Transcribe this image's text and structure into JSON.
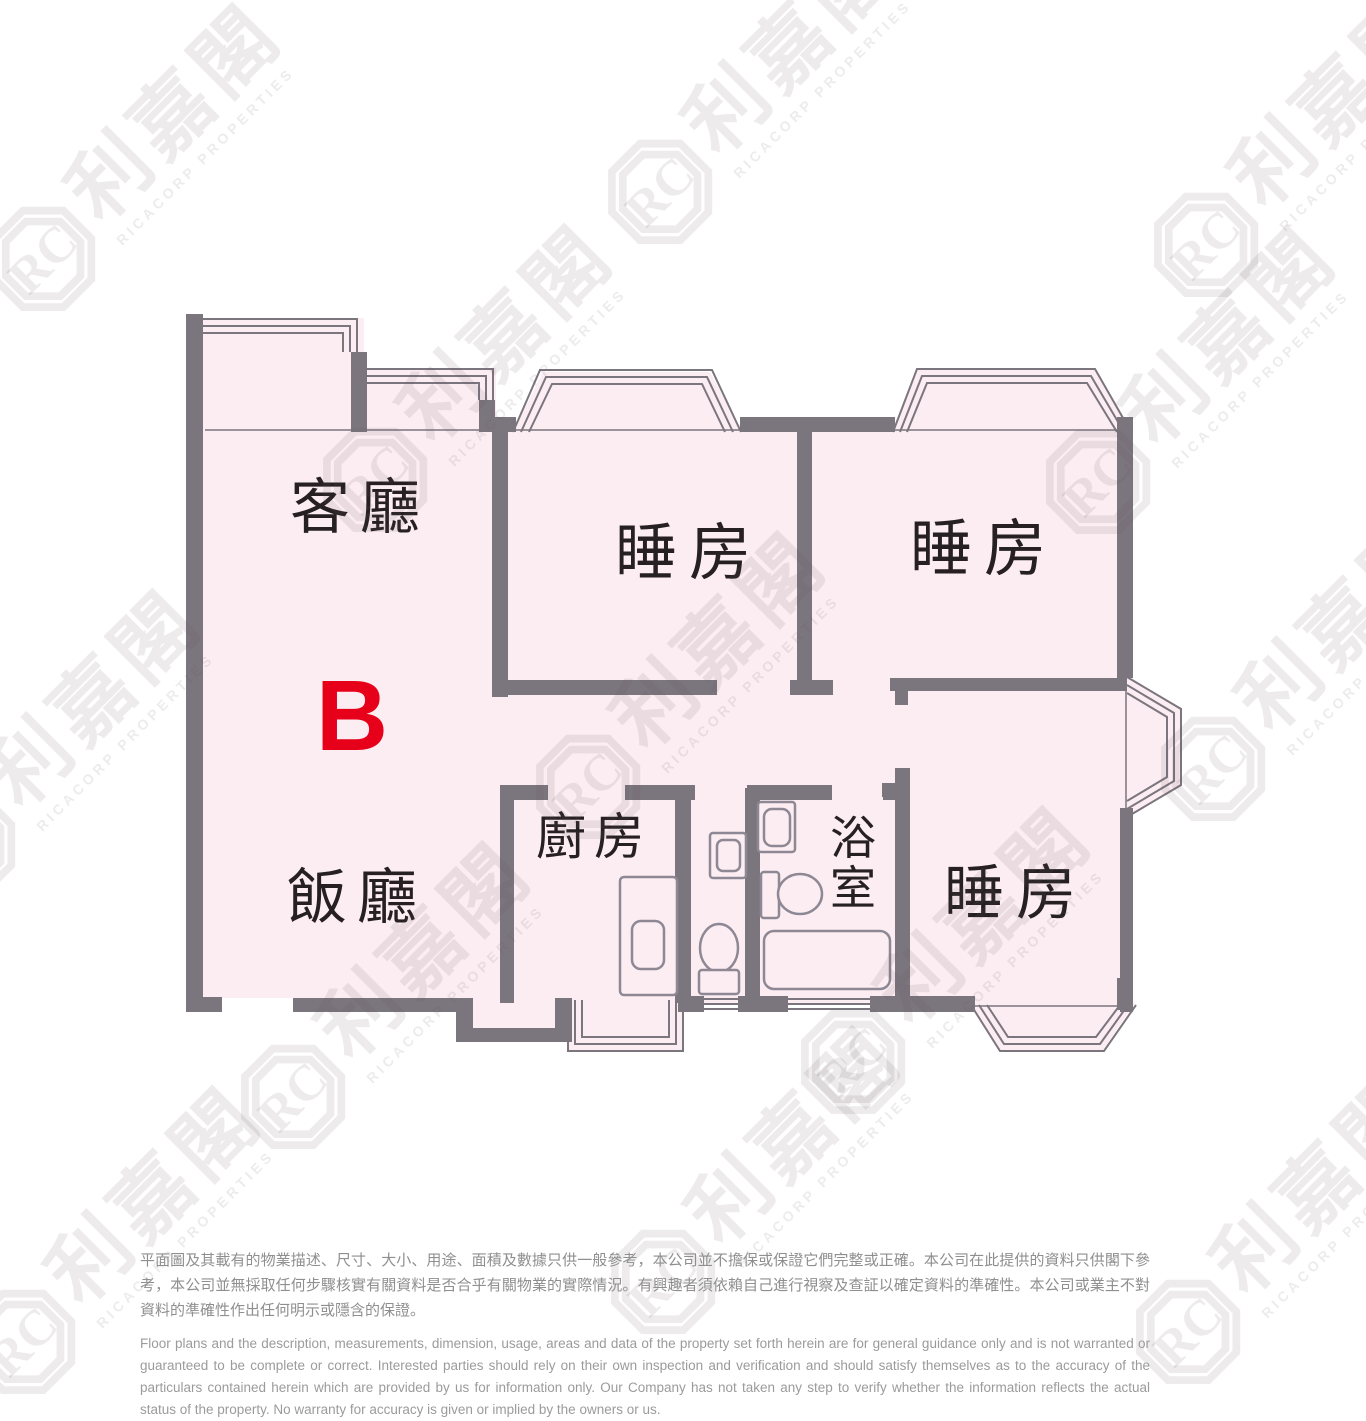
{
  "company": {
    "name_zh": "利嘉閣",
    "name_en": "RICACORP PROPERTIES",
    "logo_initials": "RC"
  },
  "floor_plan": {
    "unit_label": "B",
    "rooms": [
      {
        "id": "living-room",
        "label": "客廳"
      },
      {
        "id": "bedroom-1",
        "label": "睡房"
      },
      {
        "id": "bedroom-2",
        "label": "睡房"
      },
      {
        "id": "dining-room",
        "label": "飯廳"
      },
      {
        "id": "kitchen",
        "label": "廚房"
      },
      {
        "id": "bathroom",
        "label": "浴室",
        "char_top": "浴",
        "char_bottom": "室"
      },
      {
        "id": "bedroom-3",
        "label": "睡房"
      }
    ],
    "colors": {
      "wall": "#7b757d",
      "room_fill": "#fcedf2",
      "unit_label": "#e60019",
      "label_text": "#262023"
    }
  },
  "disclaimer": {
    "zh": "平面圖及其載有的物業描述、尺寸、大小、用途、面積及數據只供一般參考，本公司並不擔保或保證它們完整或正確。本公司在此提供的資料只供閣下參考，本公司並無採取任何步驟核實有關資料是否合乎有關物業的實際情況。有興趣者須依賴自己進行視察及查証以確定資料的準確性。本公司或業主不對資料的準確性作出任何明示或隱含的保證。",
    "en": "Floor plans and the description, measurements, dimension, usage, areas and data of the property set forth herein are for general guidance only and is not warranted or guaranteed to be complete or correct.  Interested parties should rely on their own inspection and verification and should satisfy themselves as to the accuracy of the particulars contained herein which are provided by us for information only.  Our Company has not taken any step to verify whether the information reflects the actual status of the property.  No warranty for accuracy is given or implied by the owners or us."
  }
}
